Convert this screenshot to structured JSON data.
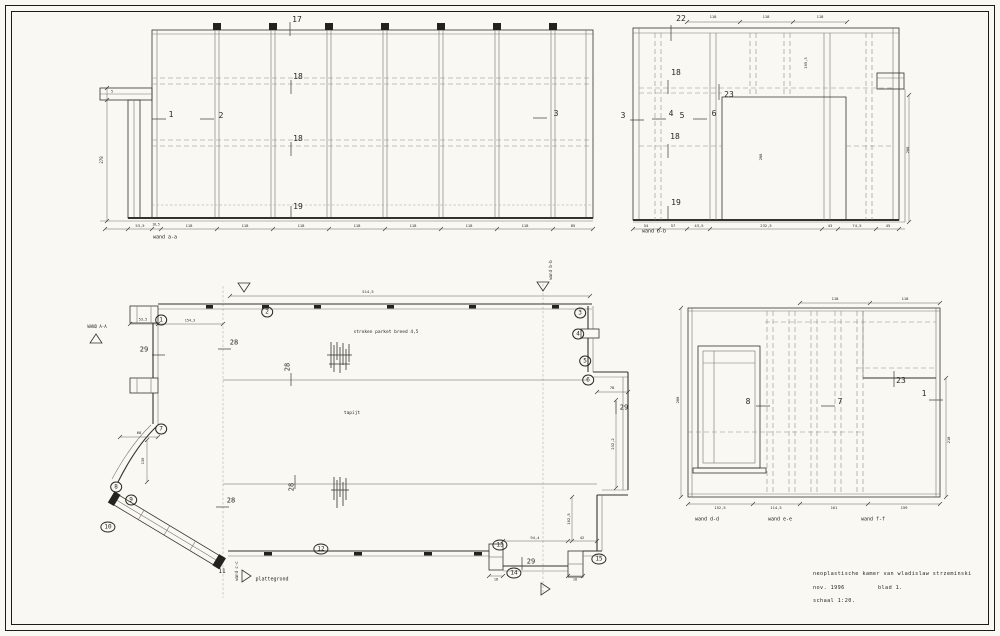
{
  "title_block": {
    "line1": "neoplastische kamer van wladislaw strzeminski",
    "date": "nov. 1996",
    "sheet": "blad 1.",
    "scale": "schaal 1:20."
  },
  "colors": {
    "paper": "#f9f8f3",
    "ink": "#34322c",
    "faint": "#8f8c83"
  },
  "annotations": {
    "wall_a": [
      {
        "n": "pos-17",
        "t": "17",
        "x": 297,
        "y": 20,
        "fs": 8
      },
      {
        "n": "pos-18-upper",
        "t": "18",
        "x": 298,
        "y": 77,
        "fs": 8
      },
      {
        "n": "pos-18-lower",
        "t": "18",
        "x": 298,
        "y": 139,
        "fs": 8
      },
      {
        "n": "pos-19",
        "t": "19",
        "x": 298,
        "y": 207,
        "fs": 8
      },
      {
        "n": "pos-1",
        "t": "1",
        "x": 171,
        "y": 115,
        "fs": 8
      },
      {
        "n": "pos-2",
        "t": "2",
        "x": 221,
        "y": 116,
        "fs": 8
      },
      {
        "n": "pos-3",
        "t": "3",
        "x": 556,
        "y": 114,
        "fs": 8
      },
      {
        "n": "dim",
        "t": "5",
        "x": 112,
        "y": 92,
        "fs": 3.5
      },
      {
        "n": "dim-height",
        "t": "278",
        "x": 102,
        "y": 160,
        "fs": 4,
        "rot": -90
      },
      {
        "n": "dim",
        "t": "53,5",
        "x": 140,
        "y": 226,
        "fs": 3.8
      },
      {
        "n": "dim",
        "t": "18,5",
        "x": 156,
        "y": 225,
        "fs": 3.2
      },
      {
        "n": "dim",
        "t": "118",
        "x": 189,
        "y": 226,
        "fs": 3.8
      },
      {
        "n": "dim",
        "t": "118",
        "x": 245,
        "y": 226,
        "fs": 3.8
      },
      {
        "n": "dim",
        "t": "118",
        "x": 301,
        "y": 226,
        "fs": 3.8
      },
      {
        "n": "dim",
        "t": "118",
        "x": 357,
        "y": 226,
        "fs": 3.8
      },
      {
        "n": "dim",
        "t": "118",
        "x": 413,
        "y": 226,
        "fs": 3.8
      },
      {
        "n": "dim",
        "t": "118",
        "x": 469,
        "y": 226,
        "fs": 3.8
      },
      {
        "n": "dim",
        "t": "118",
        "x": 525,
        "y": 226,
        "fs": 3.8
      },
      {
        "n": "dim",
        "t": "85",
        "x": 573,
        "y": 226,
        "fs": 3.8
      },
      {
        "n": "wall-a-label",
        "t": "wand a-a",
        "x": 165,
        "y": 238,
        "fs": 5
      }
    ],
    "wall_b": [
      {
        "n": "pos-22",
        "t": "22",
        "x": 681,
        "y": 19,
        "fs": 8
      },
      {
        "n": "dim",
        "t": "118",
        "x": 713,
        "y": 17,
        "fs": 3.8
      },
      {
        "n": "dim",
        "t": "118",
        "x": 766,
        "y": 17,
        "fs": 3.8
      },
      {
        "n": "dim",
        "t": "118",
        "x": 820,
        "y": 17,
        "fs": 3.8
      },
      {
        "n": "pos-18-upper",
        "t": "18",
        "x": 676,
        "y": 73,
        "fs": 8
      },
      {
        "n": "pos-23",
        "t": "23",
        "x": 729,
        "y": 95,
        "fs": 8
      },
      {
        "n": "pos-3",
        "t": "3",
        "x": 623,
        "y": 116,
        "fs": 8
      },
      {
        "n": "pos-4",
        "t": "4",
        "x": 671,
        "y": 114,
        "fs": 8
      },
      {
        "n": "pos-5",
        "t": "5",
        "x": 682,
        "y": 116,
        "fs": 8
      },
      {
        "n": "pos-6",
        "t": "6",
        "x": 714,
        "y": 114,
        "fs": 8
      },
      {
        "n": "pos-18-lower",
        "t": "18",
        "x": 675,
        "y": 137,
        "fs": 8
      },
      {
        "n": "pos-19",
        "t": "19",
        "x": 676,
        "y": 203,
        "fs": 8
      },
      {
        "n": "dim",
        "t": "105,3",
        "x": 806,
        "y": 63,
        "fs": 3.8,
        "rot": -90
      },
      {
        "n": "dim",
        "t": "288",
        "x": 761,
        "y": 157,
        "fs": 3.8,
        "rot": -90
      },
      {
        "n": "dim",
        "t": "288",
        "x": 908,
        "y": 150,
        "fs": 3.8,
        "rot": -90
      },
      {
        "n": "dim",
        "t": "54",
        "x": 646,
        "y": 226,
        "fs": 3.8
      },
      {
        "n": "dim",
        "t": "57",
        "x": 673,
        "y": 226,
        "fs": 3.8
      },
      {
        "n": "dim",
        "t": "43,5",
        "x": 699,
        "y": 226,
        "fs": 3.8
      },
      {
        "n": "dim",
        "t": "232,5",
        "x": 766,
        "y": 226,
        "fs": 3.8
      },
      {
        "n": "dim",
        "t": "43",
        "x": 830,
        "y": 226,
        "fs": 3.8
      },
      {
        "n": "dim",
        "t": "74,5",
        "x": 857,
        "y": 226,
        "fs": 3.8
      },
      {
        "n": "dim",
        "t": "45",
        "x": 888,
        "y": 226,
        "fs": 3.8
      },
      {
        "n": "wall-b-label",
        "t": "wand b-b",
        "x": 654,
        "y": 232,
        "fs": 5
      }
    ],
    "plan": [
      {
        "n": "pos-1",
        "t": "1",
        "x": 161,
        "y": 320,
        "fs": 6,
        "circ": 1
      },
      {
        "n": "pos-2",
        "t": "2",
        "x": 267,
        "y": 312,
        "fs": 6,
        "circ": 1
      },
      {
        "n": "pos-3",
        "t": "3",
        "x": 580,
        "y": 313,
        "fs": 6,
        "circ": 1
      },
      {
        "n": "pos-4",
        "t": "4",
        "x": 578,
        "y": 334,
        "fs": 6,
        "circ": 1
      },
      {
        "n": "pos-5",
        "t": "5",
        "x": 585,
        "y": 361,
        "fs": 6,
        "circ": 1
      },
      {
        "n": "pos-6",
        "t": "6",
        "x": 588,
        "y": 380,
        "fs": 6,
        "circ": 1
      },
      {
        "n": "pos-7",
        "t": "7",
        "x": 161,
        "y": 429,
        "fs": 6,
        "circ": 1
      },
      {
        "n": "pos-8",
        "t": "8",
        "x": 116,
        "y": 487,
        "fs": 6,
        "circ": 1
      },
      {
        "n": "pos-9",
        "t": "9",
        "x": 131,
        "y": 500,
        "fs": 6,
        "circ": 1
      },
      {
        "n": "pos-10",
        "t": "10",
        "x": 108,
        "y": 527,
        "fs": 6,
        "circ": 1
      },
      {
        "n": "pos-11",
        "t": "11",
        "x": 222,
        "y": 572,
        "fs": 6
      },
      {
        "n": "pos-12",
        "t": "12",
        "x": 321,
        "y": 549,
        "fs": 6,
        "circ": 1
      },
      {
        "n": "pos-13",
        "t": "13",
        "x": 500,
        "y": 545,
        "fs": 6,
        "circ": 1
      },
      {
        "n": "pos-14",
        "t": "14",
        "x": 514,
        "y": 573,
        "fs": 6,
        "circ": 1
      },
      {
        "n": "pos-15",
        "t": "15",
        "x": 599,
        "y": 559,
        "fs": 6,
        "circ": 1
      },
      {
        "n": "pos-28",
        "t": "28",
        "x": 234,
        "y": 343,
        "fs": 7
      },
      {
        "n": "pos-28",
        "t": "28",
        "x": 288,
        "y": 367,
        "fs": 7,
        "rot": -90
      },
      {
        "n": "pos-28",
        "t": "28",
        "x": 231,
        "y": 501,
        "fs": 7
      },
      {
        "n": "pos-28",
        "t": "28",
        "x": 292,
        "y": 487,
        "fs": 7,
        "rot": -90
      },
      {
        "n": "pos-29",
        "t": "29",
        "x": 144,
        "y": 350,
        "fs": 7
      },
      {
        "n": "pos-29",
        "t": "29",
        "x": 624,
        "y": 408,
        "fs": 7
      },
      {
        "n": "pos-29",
        "t": "29",
        "x": 531,
        "y": 562,
        "fs": 7
      },
      {
        "n": "section-a-label",
        "t": "WAND A-A",
        "x": 97,
        "y": 327,
        "fs": 4
      },
      {
        "n": "section-b-label",
        "t": "wand b-b",
        "x": 551,
        "y": 270,
        "fs": 4,
        "rot": -90
      },
      {
        "n": "section-c-label",
        "t": "wand c-c",
        "x": 237,
        "y": 571,
        "fs": 4,
        "rot": -90
      },
      {
        "n": "plan-label",
        "t": "plattegrond",
        "x": 272,
        "y": 580,
        "fs": 5
      },
      {
        "n": "floor-note-parquet",
        "t": "stroken parket breed 4,5",
        "x": 386,
        "y": 333,
        "fs": 4.5
      },
      {
        "n": "floor-note-carpet",
        "t": "tapijt",
        "x": 352,
        "y": 414,
        "fs": 4.5
      },
      {
        "n": "dim",
        "t": "514,5",
        "x": 368,
        "y": 292,
        "fs": 3.8
      },
      {
        "n": "dim",
        "t": "53,5",
        "x": 143,
        "y": 320,
        "fs": 3.5
      },
      {
        "n": "dim",
        "t": "154,3",
        "x": 190,
        "y": 321,
        "fs": 3.5
      },
      {
        "n": "dim",
        "t": "68",
        "x": 139,
        "y": 433,
        "fs": 3.8
      },
      {
        "n": "dim",
        "t": "130",
        "x": 143,
        "y": 461,
        "fs": 3.8,
        "rot": -90
      },
      {
        "n": "dim",
        "t": "78",
        "x": 612,
        "y": 388,
        "fs": 3.8
      },
      {
        "n": "dim",
        "t": "232,2",
        "x": 613,
        "y": 444,
        "fs": 3.8,
        "rot": -90
      },
      {
        "n": "dim",
        "t": "102,5",
        "x": 569,
        "y": 519,
        "fs": 3.8,
        "rot": -90
      },
      {
        "n": "dim",
        "t": "94,4",
        "x": 535,
        "y": 538,
        "fs": 3.8
      },
      {
        "n": "dim",
        "t": "42",
        "x": 582,
        "y": 538,
        "fs": 3.8
      },
      {
        "n": "dim",
        "t": "18",
        "x": 496,
        "y": 580,
        "fs": 3.5
      },
      {
        "n": "dim",
        "t": "18",
        "x": 575,
        "y": 580,
        "fs": 3.5
      }
    ],
    "wall_def": [
      {
        "n": "pos-8",
        "t": "8",
        "x": 748,
        "y": 402,
        "fs": 8
      },
      {
        "n": "pos-7",
        "t": "7",
        "x": 840,
        "y": 402,
        "fs": 8
      },
      {
        "n": "pos-23",
        "t": "23",
        "x": 901,
        "y": 381,
        "fs": 8
      },
      {
        "n": "pos-1",
        "t": "1",
        "x": 924,
        "y": 394,
        "fs": 8
      },
      {
        "n": "dim",
        "t": "118",
        "x": 835,
        "y": 299,
        "fs": 3.8
      },
      {
        "n": "dim",
        "t": "118",
        "x": 905,
        "y": 299,
        "fs": 3.8
      },
      {
        "n": "dim",
        "t": "288",
        "x": 678,
        "y": 400,
        "fs": 3.8,
        "rot": -90
      },
      {
        "n": "dim",
        "t": "218",
        "x": 949,
        "y": 440,
        "fs": 3.8,
        "rot": -90
      },
      {
        "n": "dim",
        "t": "152,5",
        "x": 720,
        "y": 508,
        "fs": 3.8
      },
      {
        "n": "dim",
        "t": "114,5",
        "x": 776,
        "y": 508,
        "fs": 3.8
      },
      {
        "n": "dim",
        "t": "161",
        "x": 834,
        "y": 508,
        "fs": 3.8
      },
      {
        "n": "dim",
        "t": "159",
        "x": 904,
        "y": 508,
        "fs": 3.8
      },
      {
        "n": "wall-d-label",
        "t": "wand d-d",
        "x": 707,
        "y": 520,
        "fs": 5
      },
      {
        "n": "wall-e-label",
        "t": "wand e-e",
        "x": 780,
        "y": 520,
        "fs": 5
      },
      {
        "n": "wall-f-label",
        "t": "wand f-f",
        "x": 873,
        "y": 520,
        "fs": 5
      }
    ]
  }
}
